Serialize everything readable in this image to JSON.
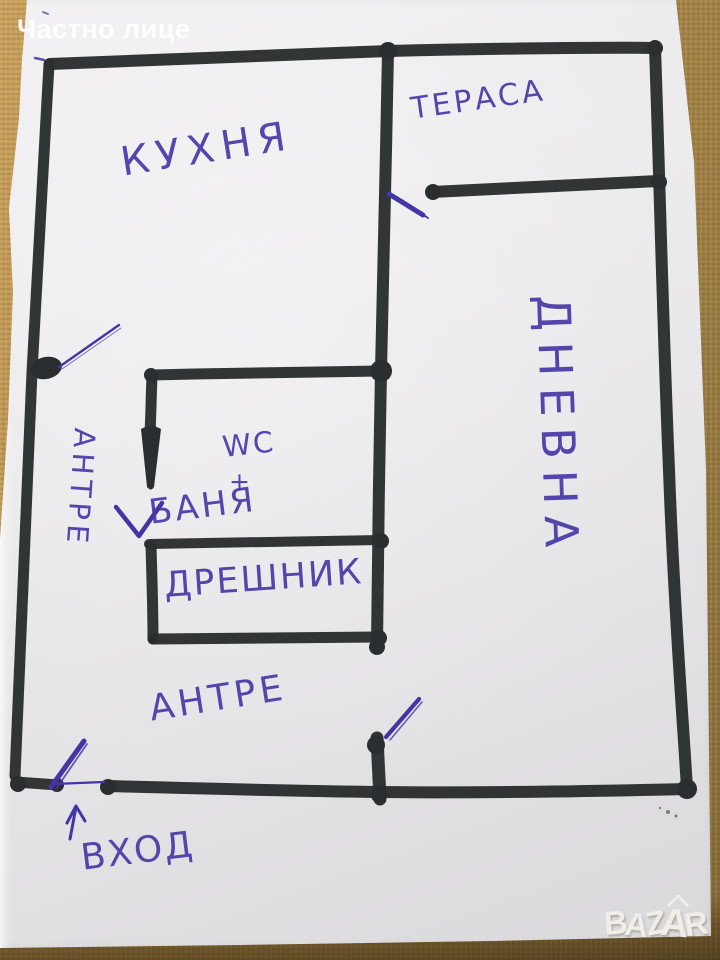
{
  "photo": {
    "seller_badge": "Частно лице",
    "watermark": {
      "brand": "BAZAR",
      "letters": [
        "B",
        "A",
        "Z",
        "A",
        "R"
      ]
    }
  },
  "floor_plan": {
    "type": "hand-drawn apartment sketch",
    "labels": {
      "kitchen": "КУХНЯ",
      "terrace": "ТЕРАСА",
      "living_room": "ДНЕВНА",
      "wc": "WC",
      "plus": "+",
      "bath": "БАНЯ",
      "closet": "ДРЕШНИК",
      "hallway_side": "АНТРЕ",
      "hallway_bottom": "АНТРЕ",
      "entrance": "ВХОД"
    }
  },
  "colors": {
    "marker_ink": "#2b2e30",
    "pen_ink": "#4638a7",
    "paper": "#e9e8ea",
    "tablecloth": "#b58d4e",
    "badge_text": "#ffffff",
    "watermark_text": "#f3f0ea"
  }
}
